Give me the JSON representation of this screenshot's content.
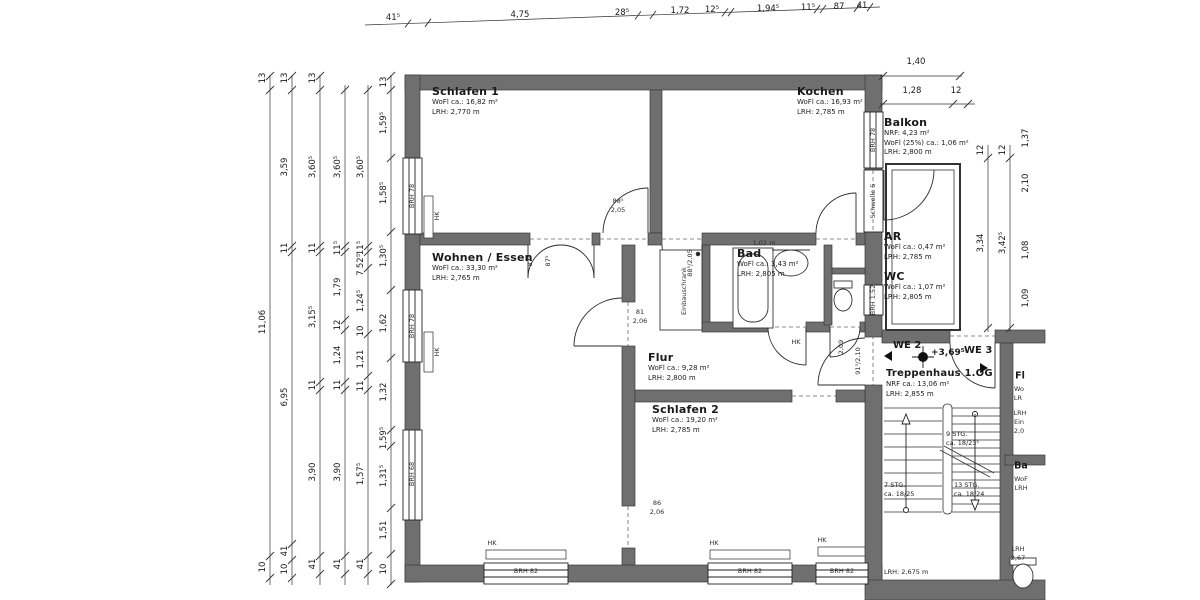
{
  "drawing": {
    "colors": {
      "wall": "#6f6f6f",
      "line": "#2b2b2b",
      "text": "#1a1a1a",
      "bg": "#ffffff"
    },
    "rooms": {
      "schlafen1": {
        "name": "Schlafen 1",
        "area": "WoFl ca.: 16,82 m²",
        "height": "LRH: 2,770 m"
      },
      "kochen": {
        "name": "Kochen",
        "area": "WoFl ca.: 16,93 m²",
        "height": "LRH: 2,785 m"
      },
      "balkon": {
        "name": "Balkon",
        "nrf": "NRF: 4,23 m²",
        "area": "WoFl (25%) ca.: 1,06 m²",
        "height": "LRH: 2,800 m"
      },
      "wohnen": {
        "name": "Wohnen / Essen",
        "area": "WoFl ca.: 33,30 m²",
        "height": "LRH: 2,765 m"
      },
      "bad": {
        "name": "Bad",
        "area": "WoFl ca.: 3,43 m²",
        "height": "LRH: 2,805 m"
      },
      "ar": {
        "name": "AR",
        "area": "WoFl ca.: 0,47 m²",
        "height": "LRH: 2,785 m"
      },
      "wc": {
        "name": "WC",
        "area": "WoFl ca.: 1,07 m²",
        "height": "LRH: 2,805 m"
      },
      "flur": {
        "name": "Flur",
        "area": "WoFl ca.: 9,28 m²",
        "height": "LRH: 2,800 m"
      },
      "schlafen2": {
        "name": "Schlafen 2",
        "area": "WoFl ca.: 19,20 m²",
        "height": "LRH: 2,785 m"
      },
      "treppenhaus": {
        "name": "Treppenhaus 1.OG",
        "area": "NRF ca.: 13,06 m²",
        "height": "LRH: 2,855 m"
      }
    },
    "units": {
      "we2": "WE 2",
      "we3": "WE 3",
      "level": "+3,69⁵"
    },
    "stairs": {
      "flight_top": "9 STG.",
      "flight_top_dim": "ca. 18/23⁵",
      "flight_left": "7 STG.",
      "flight_left_dim": "ca. 18/25",
      "flight_right": "13 STG.",
      "flight_right_dim": "ca. 18/24",
      "lrh": "LRH: 2,675 m"
    },
    "annotations": [
      {
        "t": "41⁵",
        "x": 393,
        "y": 18,
        "c": "d",
        "n": "dim-top"
      },
      {
        "t": "4,75",
        "x": 520,
        "y": 15,
        "c": "d",
        "n": "dim-top"
      },
      {
        "t": "28⁵",
        "x": 622,
        "y": 13,
        "c": "d",
        "n": "dim-top"
      },
      {
        "t": "1,72",
        "x": 680,
        "y": 11,
        "c": "d",
        "n": "dim-top"
      },
      {
        "t": "12⁵",
        "x": 712,
        "y": 10,
        "c": "d",
        "n": "dim-top"
      },
      {
        "t": "1,94⁵",
        "x": 768,
        "y": 9,
        "c": "d",
        "n": "dim-top"
      },
      {
        "t": "11⁵",
        "x": 808,
        "y": 8,
        "c": "d",
        "n": "dim-top"
      },
      {
        "t": "87",
        "x": 839,
        "y": 7,
        "c": "d",
        "n": "dim-top"
      },
      {
        "t": "41",
        "x": 862,
        "y": 6,
        "c": "d",
        "n": "dim-top"
      },
      {
        "t": "13",
        "x": 263,
        "y": 78,
        "c": "dr",
        "n": "dim-left"
      },
      {
        "t": "11,06",
        "x": 263,
        "y": 322,
        "c": "dr",
        "n": "dim-left"
      },
      {
        "t": "10",
        "x": 263,
        "y": 567,
        "c": "dr",
        "n": "dim-left"
      },
      {
        "t": "13",
        "x": 285,
        "y": 78,
        "c": "dr",
        "n": "dim-left"
      },
      {
        "t": "3,59",
        "x": 285,
        "y": 167,
        "c": "dr",
        "n": "dim-left"
      },
      {
        "t": "11",
        "x": 285,
        "y": 248,
        "c": "dr",
        "n": "dim-left"
      },
      {
        "t": "6,95",
        "x": 285,
        "y": 397,
        "c": "dr",
        "n": "dim-left"
      },
      {
        "t": "41",
        "x": 285,
        "y": 551,
        "c": "dr",
        "n": "dim-left"
      },
      {
        "t": "10",
        "x": 285,
        "y": 569,
        "c": "dr",
        "n": "dim-left"
      },
      {
        "t": "13",
        "x": 313,
        "y": 78,
        "c": "dr",
        "n": "dim-left"
      },
      {
        "t": "3,60⁵",
        "x": 313,
        "y": 167,
        "c": "dr",
        "n": "dim-left"
      },
      {
        "t": "11",
        "x": 313,
        "y": 248,
        "c": "dr",
        "n": "dim-left"
      },
      {
        "t": "3,15⁵",
        "x": 313,
        "y": 317,
        "c": "dr",
        "n": "dim-left"
      },
      {
        "t": "11",
        "x": 313,
        "y": 385,
        "c": "dr",
        "n": "dim-left"
      },
      {
        "t": "3,90",
        "x": 313,
        "y": 472,
        "c": "dr",
        "n": "dim-left"
      },
      {
        "t": "41",
        "x": 313,
        "y": 564,
        "c": "dr",
        "n": "dim-left"
      },
      {
        "t": "3,60⁵",
        "x": 338,
        "y": 167,
        "c": "dr",
        "n": "dim-left"
      },
      {
        "t": "11⁵",
        "x": 338,
        "y": 248,
        "c": "dr",
        "n": "dim-left"
      },
      {
        "t": "1,79",
        "x": 338,
        "y": 287,
        "c": "dr",
        "n": "dim-left"
      },
      {
        "t": "12",
        "x": 338,
        "y": 325,
        "c": "dr",
        "n": "dim-left"
      },
      {
        "t": "1,24",
        "x": 338,
        "y": 355,
        "c": "dr",
        "n": "dim-left"
      },
      {
        "t": "11",
        "x": 338,
        "y": 385,
        "c": "dr",
        "n": "dim-left"
      },
      {
        "t": "3,90",
        "x": 338,
        "y": 472,
        "c": "dr",
        "n": "dim-left"
      },
      {
        "t": "41",
        "x": 338,
        "y": 564,
        "c": "dr",
        "n": "dim-left"
      },
      {
        "t": "3,60⁵",
        "x": 361,
        "y": 167,
        "c": "dr",
        "n": "dim-left"
      },
      {
        "t": "11⁵",
        "x": 361,
        "y": 248,
        "c": "dr",
        "n": "dim-left"
      },
      {
        "t": "52⁵",
        "x": 361,
        "y": 261,
        "c": "dr",
        "n": "dim-left"
      },
      {
        "t": "7",
        "x": 361,
        "y": 273,
        "c": "dr",
        "n": "dim-left"
      },
      {
        "t": "1,24⁵",
        "x": 361,
        "y": 301,
        "c": "dr",
        "n": "dim-left"
      },
      {
        "t": "10",
        "x": 361,
        "y": 331,
        "c": "dr",
        "n": "dim-left"
      },
      {
        "t": "1,21",
        "x": 361,
        "y": 359,
        "c": "dr",
        "n": "dim-left"
      },
      {
        "t": "11",
        "x": 361,
        "y": 386,
        "c": "dr",
        "n": "dim-left"
      },
      {
        "t": "1,57⁵",
        "x": 361,
        "y": 474,
        "c": "dr",
        "n": "dim-left"
      },
      {
        "t": "41",
        "x": 361,
        "y": 564,
        "c": "dr",
        "n": "dim-left"
      },
      {
        "t": "13",
        "x": 384,
        "y": 82,
        "c": "dr",
        "n": "dim-left"
      },
      {
        "t": "1,59⁵",
        "x": 384,
        "y": 123,
        "c": "dr",
        "n": "dim-left"
      },
      {
        "t": "1,58⁵",
        "x": 384,
        "y": 193,
        "c": "dr",
        "n": "dim-left"
      },
      {
        "t": "1,30⁵",
        "x": 384,
        "y": 256,
        "c": "dr",
        "n": "dim-left"
      },
      {
        "t": "1,62",
        "x": 384,
        "y": 323,
        "c": "dr",
        "n": "dim-left"
      },
      {
        "t": "1,32",
        "x": 384,
        "y": 392,
        "c": "dr",
        "n": "dim-left"
      },
      {
        "t": "1,59⁵",
        "x": 384,
        "y": 438,
        "c": "dr",
        "n": "dim-left"
      },
      {
        "t": "1,31⁵",
        "x": 384,
        "y": 476,
        "c": "dr",
        "n": "dim-left"
      },
      {
        "t": "1,51",
        "x": 384,
        "y": 530,
        "c": "dr",
        "n": "dim-left"
      },
      {
        "t": "10",
        "x": 384,
        "y": 569,
        "c": "dr",
        "n": "dim-left"
      },
      {
        "t": "1,40",
        "x": 916,
        "y": 62,
        "c": "d",
        "n": "dim-balkon"
      },
      {
        "t": "1,28",
        "x": 912,
        "y": 91,
        "c": "d",
        "n": "dim-balkon"
      },
      {
        "t": "12",
        "x": 956,
        "y": 91,
        "c": "d",
        "n": "dim-balkon"
      },
      {
        "t": "12",
        "x": 981,
        "y": 150,
        "c": "dr",
        "n": "dim-right"
      },
      {
        "t": "3,34",
        "x": 981,
        "y": 243,
        "c": "dr",
        "n": "dim-right"
      },
      {
        "t": "12",
        "x": 1003,
        "y": 150,
        "c": "dr",
        "n": "dim-right"
      },
      {
        "t": "3,42⁵",
        "x": 1003,
        "y": 243,
        "c": "dr",
        "n": "dim-right"
      },
      {
        "t": "1,37",
        "x": 1026,
        "y": 138,
        "c": "dr",
        "n": "dim-right"
      },
      {
        "t": "2,10",
        "x": 1026,
        "y": 183,
        "c": "dr",
        "n": "dim-right"
      },
      {
        "t": "1,08",
        "x": 1026,
        "y": 250,
        "c": "dr",
        "n": "dim-right"
      },
      {
        "t": "1,09",
        "x": 1026,
        "y": 298,
        "c": "dr",
        "n": "dim-right"
      },
      {
        "t": "BRH 78",
        "x": 412,
        "y": 196,
        "c": "wr",
        "n": "window-label"
      },
      {
        "t": "BRH 78",
        "x": 412,
        "y": 326,
        "c": "wr",
        "n": "window-label"
      },
      {
        "t": "BRH 68",
        "x": 412,
        "y": 474,
        "c": "wr",
        "n": "window-label"
      },
      {
        "t": "BRH 78",
        "x": 873,
        "y": 140,
        "c": "wr",
        "n": "window-label"
      },
      {
        "t": "Schwelle 5",
        "x": 873,
        "y": 201,
        "c": "wr",
        "n": "threshold-label"
      },
      {
        "t": "BRH 1,52",
        "x": 873,
        "y": 300,
        "c": "wr",
        "n": "window-label"
      },
      {
        "t": "BRH 82",
        "x": 526,
        "y": 571,
        "c": "w",
        "n": "window-label"
      },
      {
        "t": "BRH 82",
        "x": 750,
        "y": 571,
        "c": "w",
        "n": "window-label"
      },
      {
        "t": "BRH 82",
        "x": 842,
        "y": 571,
        "c": "w",
        "n": "window-label"
      },
      {
        "t": "HK",
        "x": 492,
        "y": 543,
        "c": "xs",
        "n": "radiator-label"
      },
      {
        "t": "HK",
        "x": 714,
        "y": 543,
        "c": "xs",
        "n": "radiator-label"
      },
      {
        "t": "HK",
        "x": 822,
        "y": 540,
        "c": "xs",
        "n": "radiator-label"
      },
      {
        "t": "HK",
        "x": 796,
        "y": 342,
        "c": "xs",
        "n": "radiator-label"
      },
      {
        "t": "HK",
        "x": 437,
        "y": 216,
        "c": "xsr",
        "n": "radiator-label"
      },
      {
        "t": "HK",
        "x": 437,
        "y": 352,
        "c": "xsr",
        "n": "radiator-label"
      },
      {
        "t": "88⁵",
        "x": 618,
        "y": 201,
        "c": "xs",
        "n": "door-size"
      },
      {
        "t": "2,05",
        "x": 618,
        "y": 210,
        "c": "xs",
        "n": "door-size"
      },
      {
        "t": "81",
        "x": 640,
        "y": 312,
        "c": "xs",
        "n": "door-size"
      },
      {
        "t": "2,06",
        "x": 640,
        "y": 321,
        "c": "xs",
        "n": "door-size"
      },
      {
        "t": "86",
        "x": 657,
        "y": 503,
        "c": "xs",
        "n": "door-size"
      },
      {
        "t": "2,06",
        "x": 657,
        "y": 512,
        "c": "xs",
        "n": "door-size"
      },
      {
        "t": "87⁵",
        "x": 530,
        "y": 261,
        "c": "xsr",
        "n": "door-size"
      },
      {
        "t": "87⁵",
        "x": 548,
        "y": 261,
        "c": "xsr",
        "n": "door-size"
      },
      {
        "t": "88⁵/2,05",
        "x": 690,
        "y": 263,
        "c": "xsr",
        "n": "door-size"
      },
      {
        "t": "91⁵/2,10",
        "x": 858,
        "y": 361,
        "c": "xsr",
        "n": "door-size"
      },
      {
        "t": "2,09",
        "x": 841,
        "y": 347,
        "c": "xsr",
        "n": "door-size"
      },
      {
        "t": "1,02 m",
        "x": 764,
        "y": 243,
        "c": "xs",
        "n": "detail-label"
      },
      {
        "t": "Einbauschrank",
        "x": 684,
        "y": 291,
        "c": "xsr",
        "n": "closet-label"
      },
      {
        "t": "Fl",
        "x": 1020,
        "y": 376,
        "c": "tt",
        "n": "clipped-room-label"
      },
      {
        "t": "Wo",
        "x": 1019,
        "y": 389,
        "c": "xs",
        "n": "clipped-text"
      },
      {
        "t": "LR",
        "x": 1018,
        "y": 398,
        "c": "xs",
        "n": "clipped-text"
      },
      {
        "t": "LRH",
        "x": 1020,
        "y": 413,
        "c": "xs",
        "n": "clipped-text"
      },
      {
        "t": "Ein",
        "x": 1019,
        "y": 422,
        "c": "xs",
        "n": "clipped-text"
      },
      {
        "t": "2,0",
        "x": 1019,
        "y": 431,
        "c": "xs",
        "n": "clipped-text"
      },
      {
        "t": "Ba",
        "x": 1021,
        "y": 466,
        "c": "tt",
        "n": "clipped-room-label"
      },
      {
        "t": "WoF",
        "x": 1021,
        "y": 479,
        "c": "xs",
        "n": "clipped-text"
      },
      {
        "t": "LRH",
        "x": 1021,
        "y": 488,
        "c": "xs",
        "n": "clipped-text"
      },
      {
        "t": "LRH",
        "x": 1018,
        "y": 549,
        "c": "xs",
        "n": "clipped-text"
      },
      {
        "t": "2,67",
        "x": 1018,
        "y": 558,
        "c": "xs",
        "n": "clipped-text"
      }
    ]
  }
}
